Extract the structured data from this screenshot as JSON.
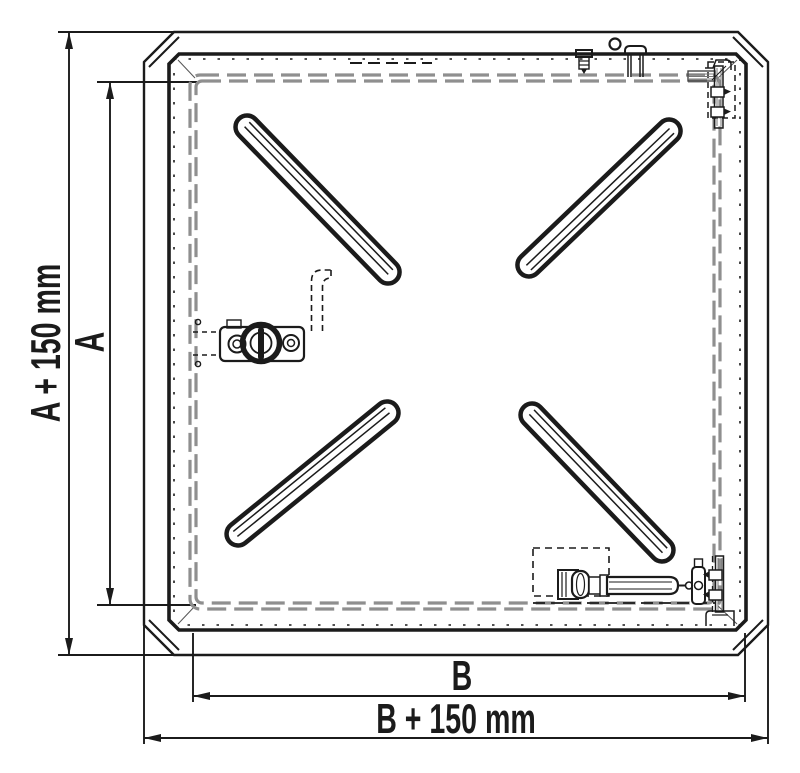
{
  "colors": {
    "ink": "#1b1b1b",
    "seal": "#8f8f8f",
    "paper": "#ffffff"
  },
  "drawing": {
    "type": "technical-drawing",
    "view": "plan view of square access hatch cover with frame",
    "dimensions": {
      "a": {
        "label": "A"
      },
      "a_plus_150": {
        "label": "A + 150 mm"
      },
      "b": {
        "label": "B"
      },
      "b_plus_150": {
        "label": "B + 150 mm"
      }
    }
  }
}
